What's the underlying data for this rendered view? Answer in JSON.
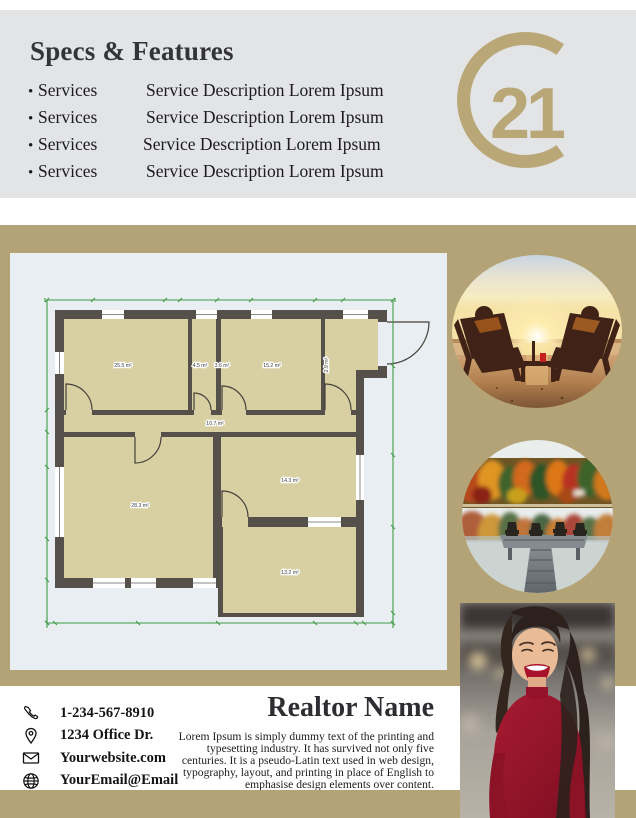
{
  "header": {
    "title": "Specs & Features",
    "bullet": "•",
    "services": [
      {
        "name": "Services",
        "description": "Service Description Lorem Ipsum"
      },
      {
        "name": "Services",
        "description": "Service Description Lorem Ipsum"
      },
      {
        "name": "Services",
        "description": "Service Description Lorem Ipsum"
      },
      {
        "name": "Services",
        "description": "Service Description Lorem Ipsum"
      }
    ]
  },
  "logo": {
    "number": "21"
  },
  "floorplan": {
    "room_labels": [
      "25.5 m²",
      "4.5 m²",
      "3.6 m²",
      "15.2 m²",
      "2.9 m²",
      "10.7 m²",
      "28.3 m²",
      "14.3 m²",
      "13.2 m²"
    ]
  },
  "contact": {
    "items": [
      {
        "icon": "phone",
        "text": "1-234-567-8910"
      },
      {
        "icon": "location-pin",
        "text": "1234 Office Dr."
      },
      {
        "icon": "envelope",
        "text": "Yourwebsite.com"
      },
      {
        "icon": "globe",
        "text": "YourEmail@Email"
      }
    ]
  },
  "realtor": {
    "name": "Realtor Name",
    "bio": "Lorem Ipsum is simply dummy text of the printing and typesetting industry. It has survived not only five centuries. It is a pseudo-Latin text used in web design, typography, layout, and printing in place of English to emphasise design elements over content."
  },
  "colors": {
    "gold": "#b4a376",
    "header_gray": "#e3e4e6",
    "logo_gold": "#b9a778",
    "card_bg": "#e8eef1",
    "dress_red": "#9c1428",
    "dim_green": "#3f9b45"
  }
}
